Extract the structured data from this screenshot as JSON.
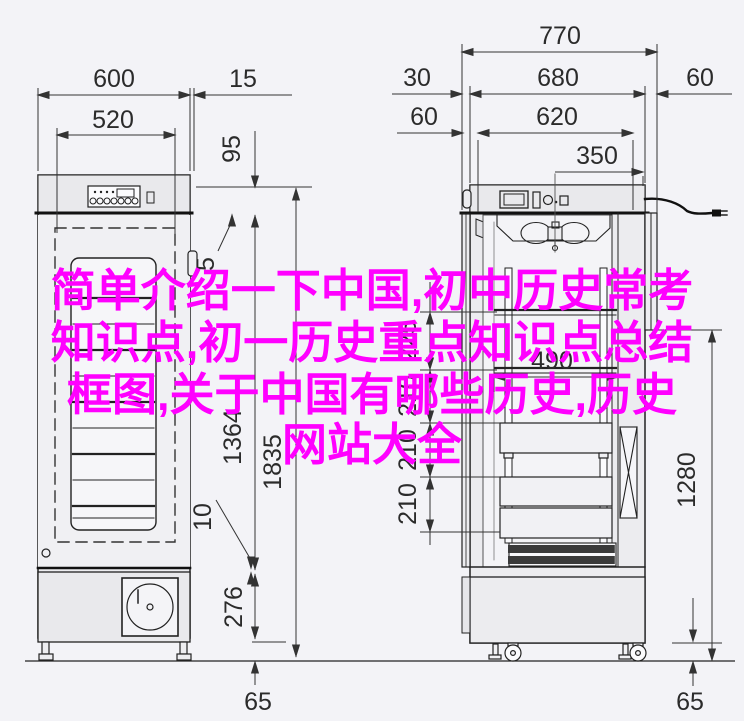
{
  "overlay": {
    "color": "#ff00ff",
    "lines": [
      "简单介绍一下中国,初中历史常考",
      "知识点,初一历史重点知识点总结",
      "框图,关于中国有哪些历史,历史",
      "网站大全"
    ]
  },
  "front_view": {
    "dims": {
      "total_width": "600",
      "side_offset": "15",
      "inner_width": "520",
      "top_height": "95",
      "hinge_gap": "5",
      "door_height": "1364",
      "total_height": "1835",
      "bottom_gap": "10",
      "base_height": "276",
      "foot_height": "65"
    }
  },
  "side_view": {
    "dims": {
      "total_depth": "770",
      "door_thickness": "30",
      "body_depth": "680",
      "rear_offset": "60",
      "front_offset": "60",
      "inner_depth": "620",
      "cord_offset": "350",
      "pitch_top": "225",
      "pitch_2": "210",
      "pitch_3": "210",
      "pitch_4": "210",
      "inner_width": "490",
      "upper_height": "1280",
      "caster_height": "65"
    }
  }
}
